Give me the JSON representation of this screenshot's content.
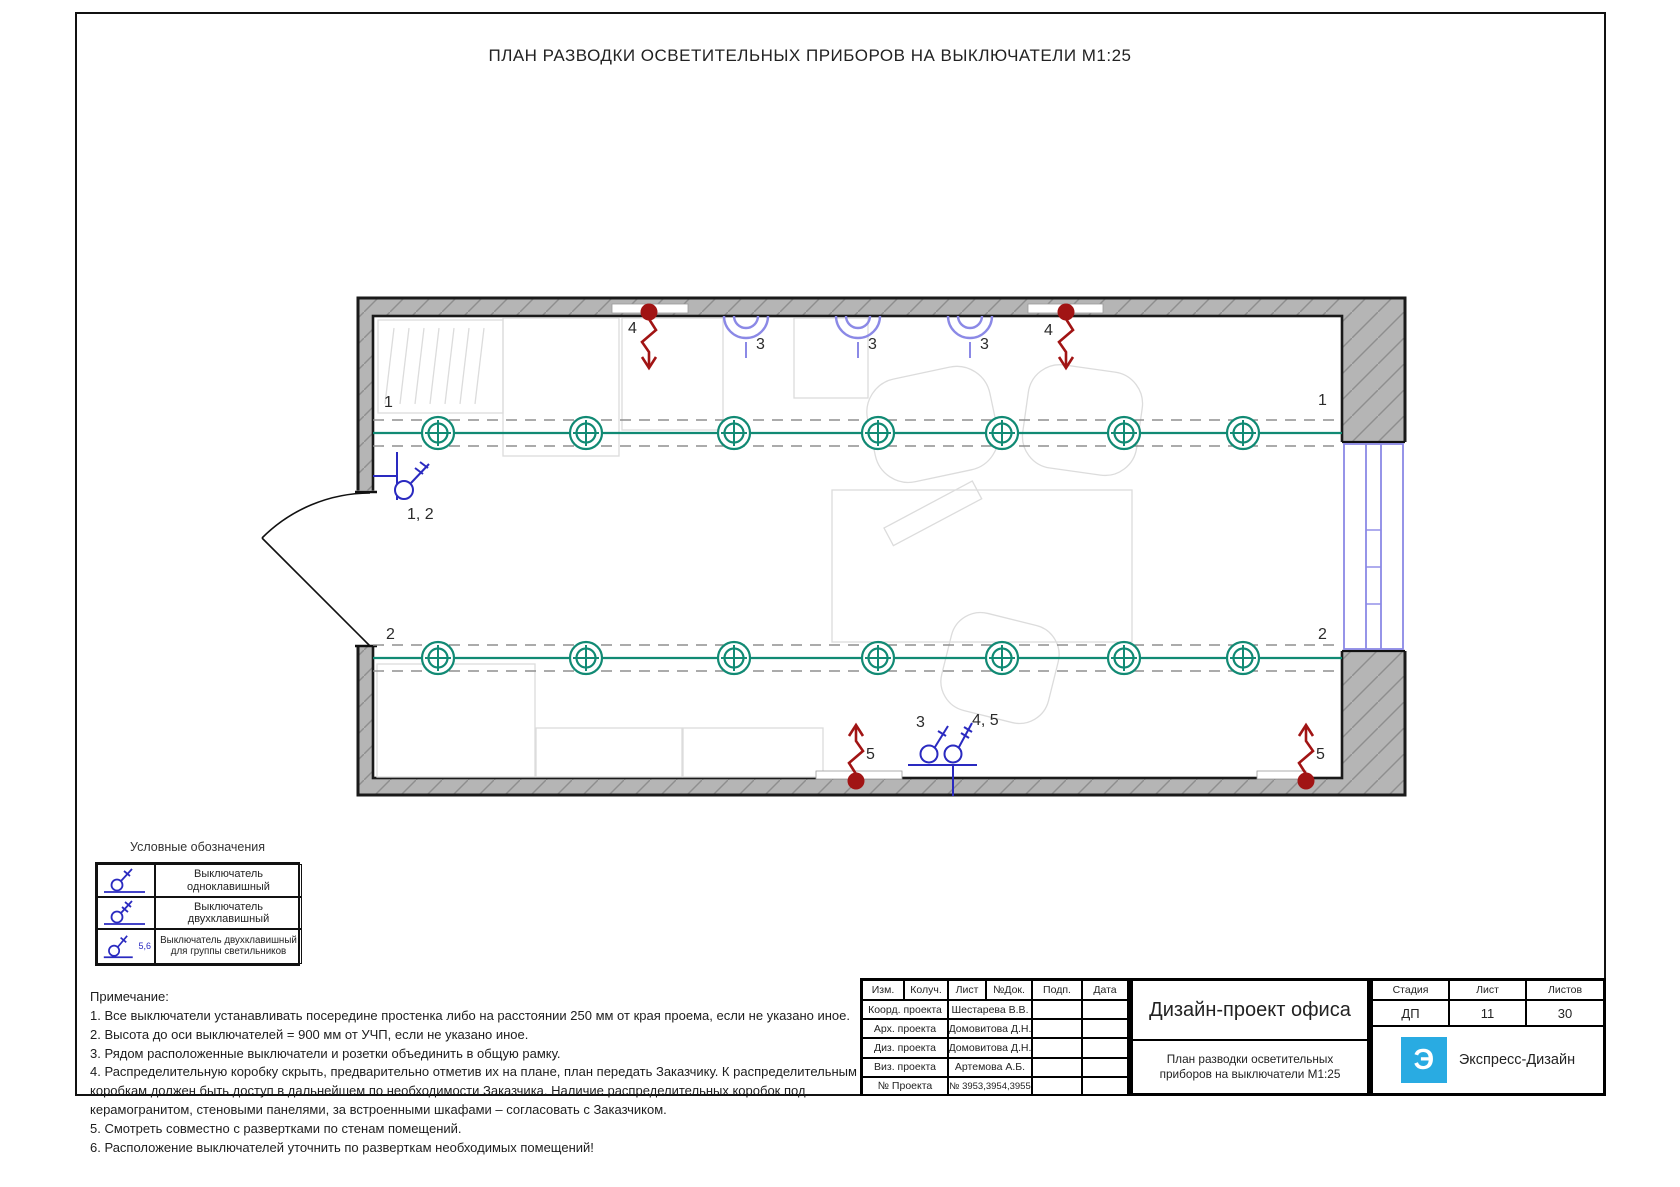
{
  "sheet_title": "ПЛАН РАЗВОДКИ ОСВЕТИТЕЛЬНЫХ ПРИБОРОВ НА ВЫКЛЮЧАТЕЛИ М1:25",
  "plan": {
    "labels": {
      "row1": "1",
      "row2": "2",
      "wall_light": "3",
      "ceiling_outlet": "4",
      "bottom_outlet": "5",
      "door_switch": "1, 2",
      "switch_group": "3",
      "switch_two": "4, 5"
    }
  },
  "legend": {
    "title": "Условные обозначения",
    "rows": [
      {
        "label": "Выключатель одноклавишный"
      },
      {
        "label": "Выключатель двухклавишный"
      },
      {
        "label": "Выключатель двухклавишный для группы светильников",
        "badge": "5,6"
      }
    ]
  },
  "notes": {
    "title": "Примечание:",
    "items": [
      "1. Все выключатели устанавливать посередине простенка либо на расстоянии 250 мм от края проема, если не указано иное.",
      "2. Высота до оси выключателей = 900 мм от УЧП, если не указано иное.",
      "3. Рядом расположенные выключатели и розетки объединить в общую рамку.",
      "4. Распределительную коробку скрыть, предварительно отметив их на плане, план передать Заказчику. К распределительным коробкам должен быть доступ в дальнейшем по необходимости Заказчика. Наличие распределительных коробок под керамогранитом, стеновыми панелями, за встроенными шкафами – согласовать с Заказчиком.",
      "5. Смотреть совместно с развертками по стенам помещений.",
      "6. Расположение выключателей уточнить по разверткам необходимых помещений!"
    ]
  },
  "titleblock": {
    "revision_headers": [
      "Изм.",
      "Колуч.",
      "Лист",
      "№Док.",
      "Подп.",
      "Дата"
    ],
    "rows": [
      {
        "role": "Коорд. проекта",
        "name": "Шестарева В.В."
      },
      {
        "role": "Арх. проекта",
        "name": "Домовитова Д.Н."
      },
      {
        "role": "Диз. проекта",
        "name": "Домовитова Д.Н."
      },
      {
        "role": "Виз. проекта",
        "name": "Артемова А.Б."
      },
      {
        "role": "№ Проекта",
        "name": "№ 3953,3954,3955"
      }
    ],
    "project_title": "Дизайн-проект офиса",
    "sheet_title": "План разводки осветительных приборов на выключатели М1:25",
    "stage_label": "Стадия",
    "stage": "ДП",
    "sheet_label": "Лист",
    "sheet": "11",
    "sheets_label": "Листов",
    "sheets": "30",
    "company": "Экспресс-Дизайн",
    "logo_letter": "Э"
  },
  "colors": {
    "light_teal": "#118a74",
    "switch_blue": "#2a2ac0",
    "wall_light_lavender": "#8b89e6",
    "outlet_red": "#a11414",
    "wall_gray": "#b5b5b5",
    "logo_cyan": "#29abe2"
  }
}
